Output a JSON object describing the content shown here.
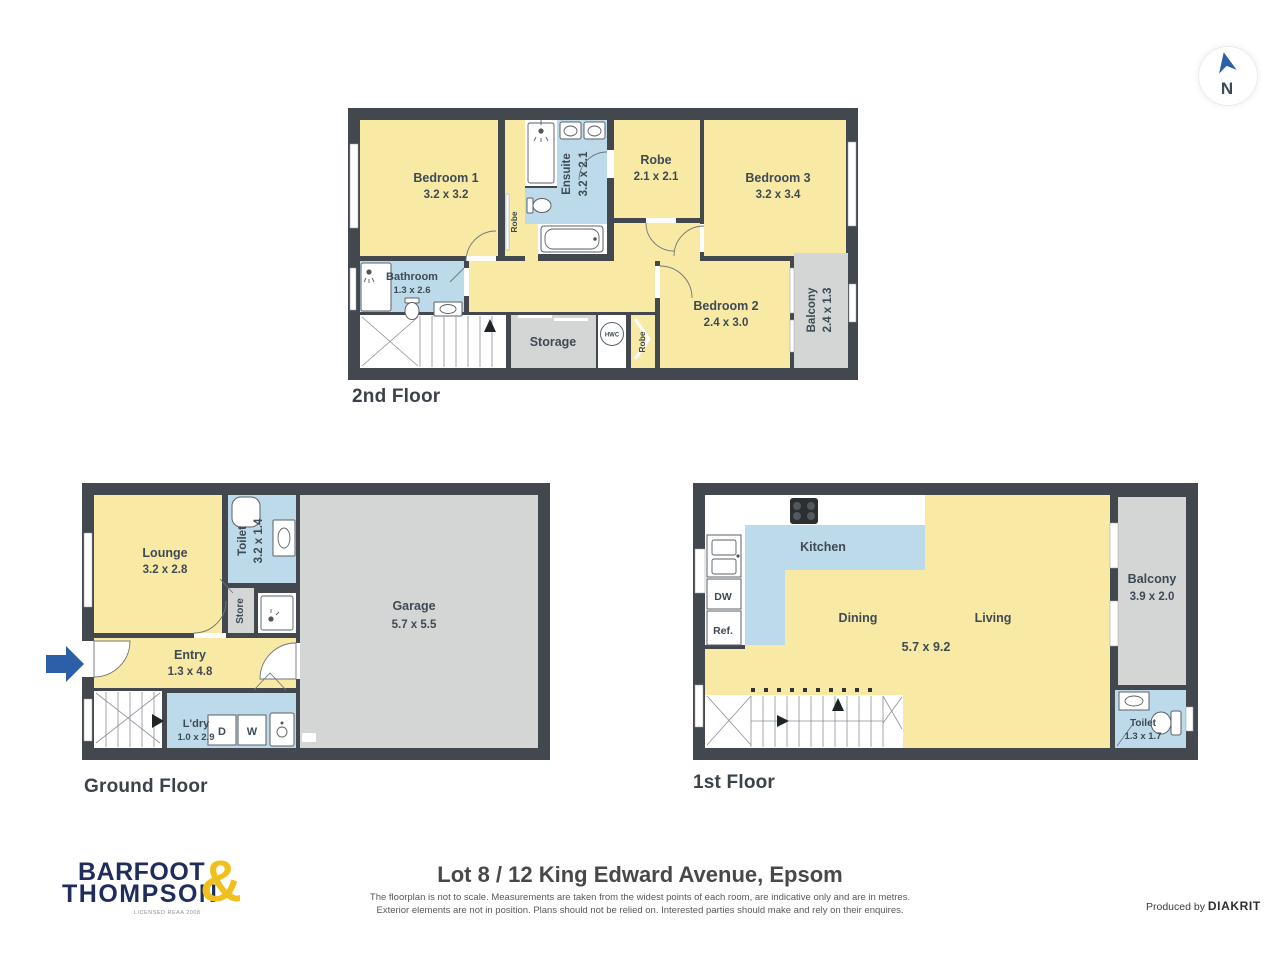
{
  "meta": {
    "address_title": "Lot 8 / 12 King Edward Avenue, Epsom",
    "disclaimer_line1": "The floorplan is not to scale. Measurements are taken from the widest points of each room, are indicative only and are in metres.",
    "disclaimer_line2": "Exterior elements are not in position. Plans should not be relied on. Interested parties should make and rely on their enquires.",
    "produced_by": "Produced by",
    "producer": "DIAKRIT"
  },
  "compass": {
    "n": "N"
  },
  "logo": {
    "word1": "BARFOOT",
    "word2": "THOMPSON",
    "amp": "&",
    "license": "LICENSED REAA 2008"
  },
  "colors": {
    "room_yellow": "#F8E9A4",
    "room_blue": "#BDDAEA",
    "room_gray": "#D4D5D5",
    "wall": "#42484E",
    "entry_arrow_blue": "#2B5FA8",
    "logo_navy": "#1E2D5C",
    "logo_gold": "#F0C11E"
  },
  "floor2": {
    "label": "2nd Floor",
    "bedroom1_name": "Bedroom 1",
    "bedroom1_dims": "3.2 x 3.2",
    "ensuite_name": "Ensuite",
    "ensuite_dims": "3.2 x 2.1",
    "robe_room_name": "Robe",
    "robe_room_dims": "2.1 x 2.1",
    "bedroom3_name": "Bedroom 3",
    "bedroom3_dims": "3.2 x 3.4",
    "bathroom_name": "Bathroom",
    "bathroom_dims": "1.3 x 2.6",
    "bedroom2_name": "Bedroom 2",
    "bedroom2_dims": "2.4 x 3.0",
    "balcony_name": "Balcony",
    "balcony_dims": "2.4 x 1.3",
    "storage_name": "Storage",
    "hwc": "HWC",
    "robe1": "Robe",
    "robe2": "Robe"
  },
  "ground": {
    "label": "Ground Floor",
    "lounge_name": "Lounge",
    "lounge_dims": "3.2 x 2.8",
    "toilet_name": "Toilet",
    "toilet_dims": "3.2 x 1.4",
    "store": "Store",
    "garage_name": "Garage",
    "garage_dims": "5.7 x 5.5",
    "entry_name": "Entry",
    "entry_dims": "1.3 x 4.8",
    "ldry_name": "L'dry",
    "ldry_dims": "1.0 x 2.9",
    "dryer": "D",
    "washer": "W"
  },
  "first": {
    "label": "1st Floor",
    "kitchen": "Kitchen",
    "dining": "Dining",
    "living": "Living",
    "living_dims": "5.7 x 9.2",
    "balcony_name": "Balcony",
    "balcony_dims": "3.9 x 2.0",
    "toilet_name": "Toilet",
    "toilet_dims": "1.3 x 1.7",
    "dw": "DW",
    "ref": "Ref."
  }
}
